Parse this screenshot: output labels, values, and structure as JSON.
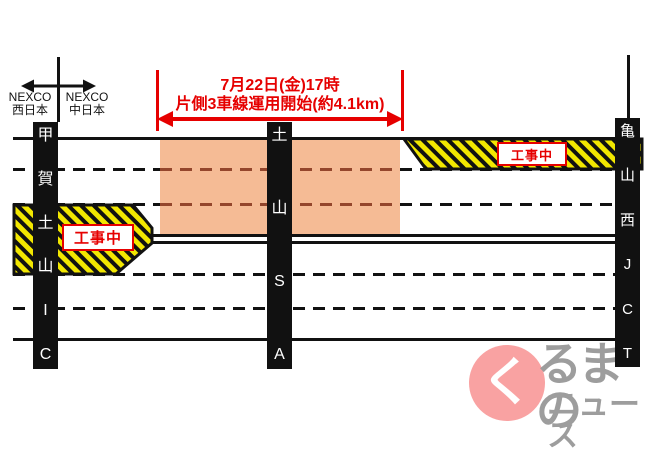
{
  "colors": {
    "red": "#e60000",
    "orange": "#f5bb95",
    "orange_dash": "#94462c",
    "hatch_yellow": "#f2e700",
    "logo_pink": "#f9a2a2",
    "logo_gray": "#9d9d9d"
  },
  "header": {
    "operator_left": {
      "name": "NEXCO",
      "region": "西日本"
    },
    "operator_right": {
      "name": "NEXCO",
      "region": "中日本"
    }
  },
  "annotation": {
    "line1": "7月22日(金)17時",
    "line2": "片側3車線運用開始(約4.1km)"
  },
  "stations": {
    "left": {
      "label": "甲賀土山IC"
    },
    "middle": {
      "label": "土山SA"
    },
    "right": {
      "label": "亀山西JCT"
    }
  },
  "construction": {
    "left_label": "工事中",
    "right_label": "工事中"
  },
  "logo": {
    "symbol": "く",
    "text_top": "るまの",
    "text_bottom": "ニュース"
  }
}
